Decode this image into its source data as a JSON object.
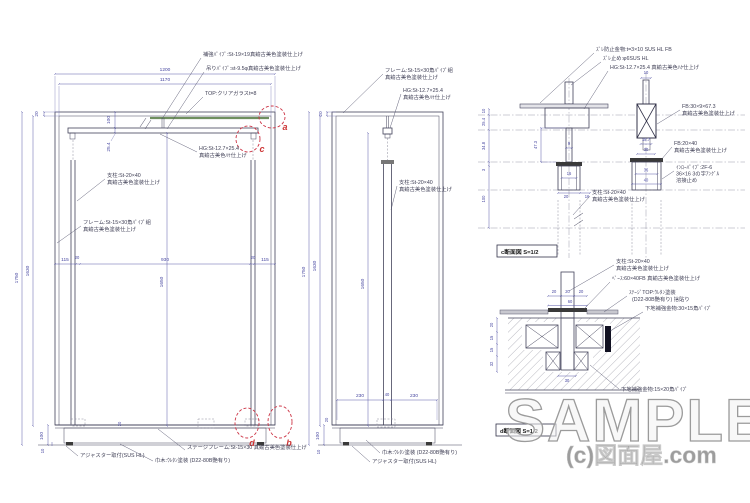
{
  "watermark": {
    "sample": "SAMPLE",
    "credit": "(c)図面屋.com"
  },
  "markers": {
    "a": "a",
    "b": "b",
    "c": "c",
    "d": "d"
  },
  "colors": {
    "line": "#42425a",
    "dimension": "#4646a0",
    "annotation": "#3f3f55",
    "marker_red": "#cc3344",
    "glass_green": "#6f8f5f",
    "watermark_gray": "#9d9d9d"
  },
  "front": {
    "dims": {
      "w1200": "1200",
      "w1170": "1170",
      "t20": "20",
      "h1750": "1750",
      "h1630": "1630",
      "h1650": "1650",
      "g100": "100",
      "g25_4": "25.4",
      "s115l": "115",
      "s20l": "20",
      "s930": "930",
      "s20r": "20",
      "s115r": "115",
      "b100": "100",
      "b20": "20",
      "b10": "10"
    },
    "notes": {
      "hokyo": "補強ﾊﾟｲﾌﾟ:St-19×19真鍮古美色塗装仕上げ",
      "tsuri": "吊りﾊﾟｲﾌﾟ:st-9.5φ真鍮古美色塗装仕上げ",
      "top": "TOP:クリアガラスt=8",
      "hg1": "HG:St-12.7×25.4",
      "hg2": "真鍮古美色ﾊｹ仕上げ",
      "post1": "支柱:St-20×40",
      "post2": "真鍮古美色塗装仕上げ",
      "frame1": "フレーム:St-15×30角ﾊﾟｲﾌﾟ組",
      "frame2": "真鍮古美色塗装仕上げ",
      "stage": "ステージフレーム:St-15×30 真鍮古美色塗装仕上げ",
      "habaki": "巾木:ｳﾚﾀﾝ塗装 (D22-80B艶有り)",
      "adjuster": "アジャスター取付(SUS HL)"
    }
  },
  "side": {
    "dims": {
      "t20": "20",
      "h1750": "1750",
      "h1630": "1630",
      "h1650": "1650",
      "b230l": "230",
      "b40": "40",
      "b230r": "230",
      "b100": "100",
      "b20": "20",
      "b10": "10"
    },
    "notes": {
      "frame1": "フレーム:St-15×30角ﾊﾟｲﾌﾟ組",
      "frame2": "真鍮古美色塗装仕上げ",
      "hg1": "HG:St-12.7×25.4",
      "hg2": "真鍮古美色ﾊｹ仕上げ",
      "post1": "支柱:St-20×40",
      "post2": "真鍮古美色塗装仕上げ",
      "habaki": "巾木:ｳﾚﾀﾝ塗装 (D22-80B艶有り)",
      "adjuster": "アジャスター取付(SUS HL)"
    }
  },
  "detail_c": {
    "label": "c断面図 S=1/2",
    "dims": {
      "d10top": "10",
      "d25_4": "25.4",
      "d34_8": "34.8",
      "d3": "3",
      "d100": "100",
      "d47_3": "47.3",
      "d9": "9",
      "d16": "16",
      "d20": "20",
      "d16b": "16",
      "p10": "10",
      "d18_7": "18.7",
      "d30": "30",
      "d36": "36",
      "d40": "40"
    },
    "notes": {
      "zure_boshi": "ｽﾞﾚ防止金物:t=3×10 SUS HL FB",
      "zure_dome": "ｽﾞﾚ止め:φ6SUS HL",
      "hg": "HG:St-12.7×25.4 真鍮古美色ﾊｹ仕上げ",
      "fb30a": "FB:30×9×67.3",
      "fb30b": "真鍮古美色塗装仕上げ",
      "fb20a": "FB:20×40",
      "fb20b": "真鍮古美色塗装仕上げ",
      "inro1": "ｲﾝﾛｰﾊﾟｲﾌﾟ:2F-6",
      "inro2": "36×16 3の字ｱﾝｸﾞﾙ",
      "inro3": "溶接止め",
      "post1": "支柱:St-20×40",
      "post2": "真鍮古美色塗装仕上げ"
    }
  },
  "detail_d": {
    "label": "d断面図 S=1/2",
    "dims": {
      "t20a": "20",
      "t20b": "20",
      "t20c": "20",
      "t60": "60",
      "b30": "30",
      "l20": "20",
      "l15a": "15",
      "l15b": "15",
      "l32": "32"
    },
    "notes": {
      "post1": "支柱:St-20×40",
      "post2": "真鍮古美色塗装仕上げ",
      "base": "ﾍﾞｰｽ:60×40FB 真鍮古美色塗装仕上げ",
      "stage1": "ｽﾃｰｼﾞTOP:ｳﾚﾀﾝ塗装",
      "stage2": "(D22-80B艶有り) 捨貼り",
      "shitaji30": "下地補強金物:30×15角ﾊﾟｲﾌﾟ",
      "shitaji15": "下地補強金物:15×20角ﾊﾟｲﾌﾟ"
    }
  }
}
